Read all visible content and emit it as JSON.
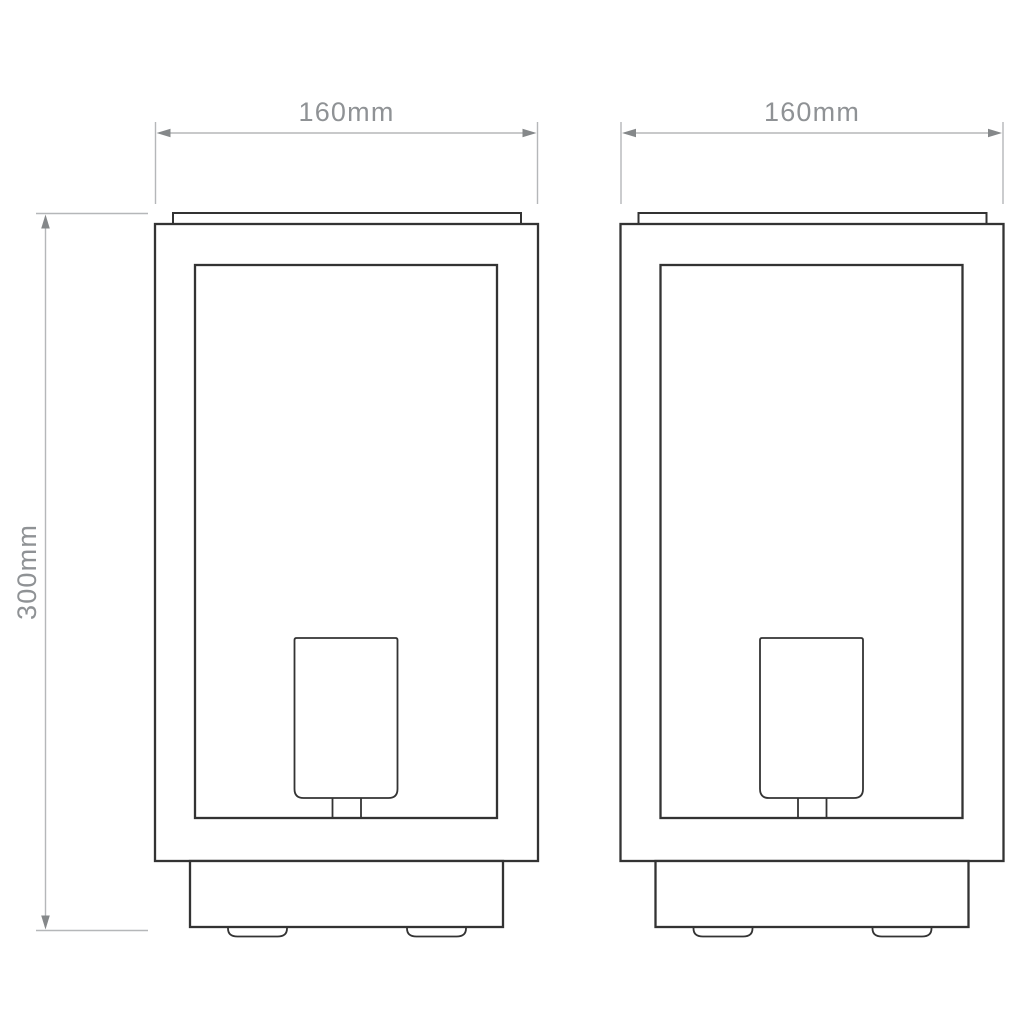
{
  "colors": {
    "background": "#ffffff",
    "outline": "#333333",
    "dimension_line": "#b5b7b9",
    "arrow": "#85888a",
    "label_text": "#8f9295"
  },
  "dimensions": {
    "width_left": {
      "label": "160mm"
    },
    "width_right": {
      "label": "160mm"
    },
    "height": {
      "label": "300mm"
    }
  }
}
